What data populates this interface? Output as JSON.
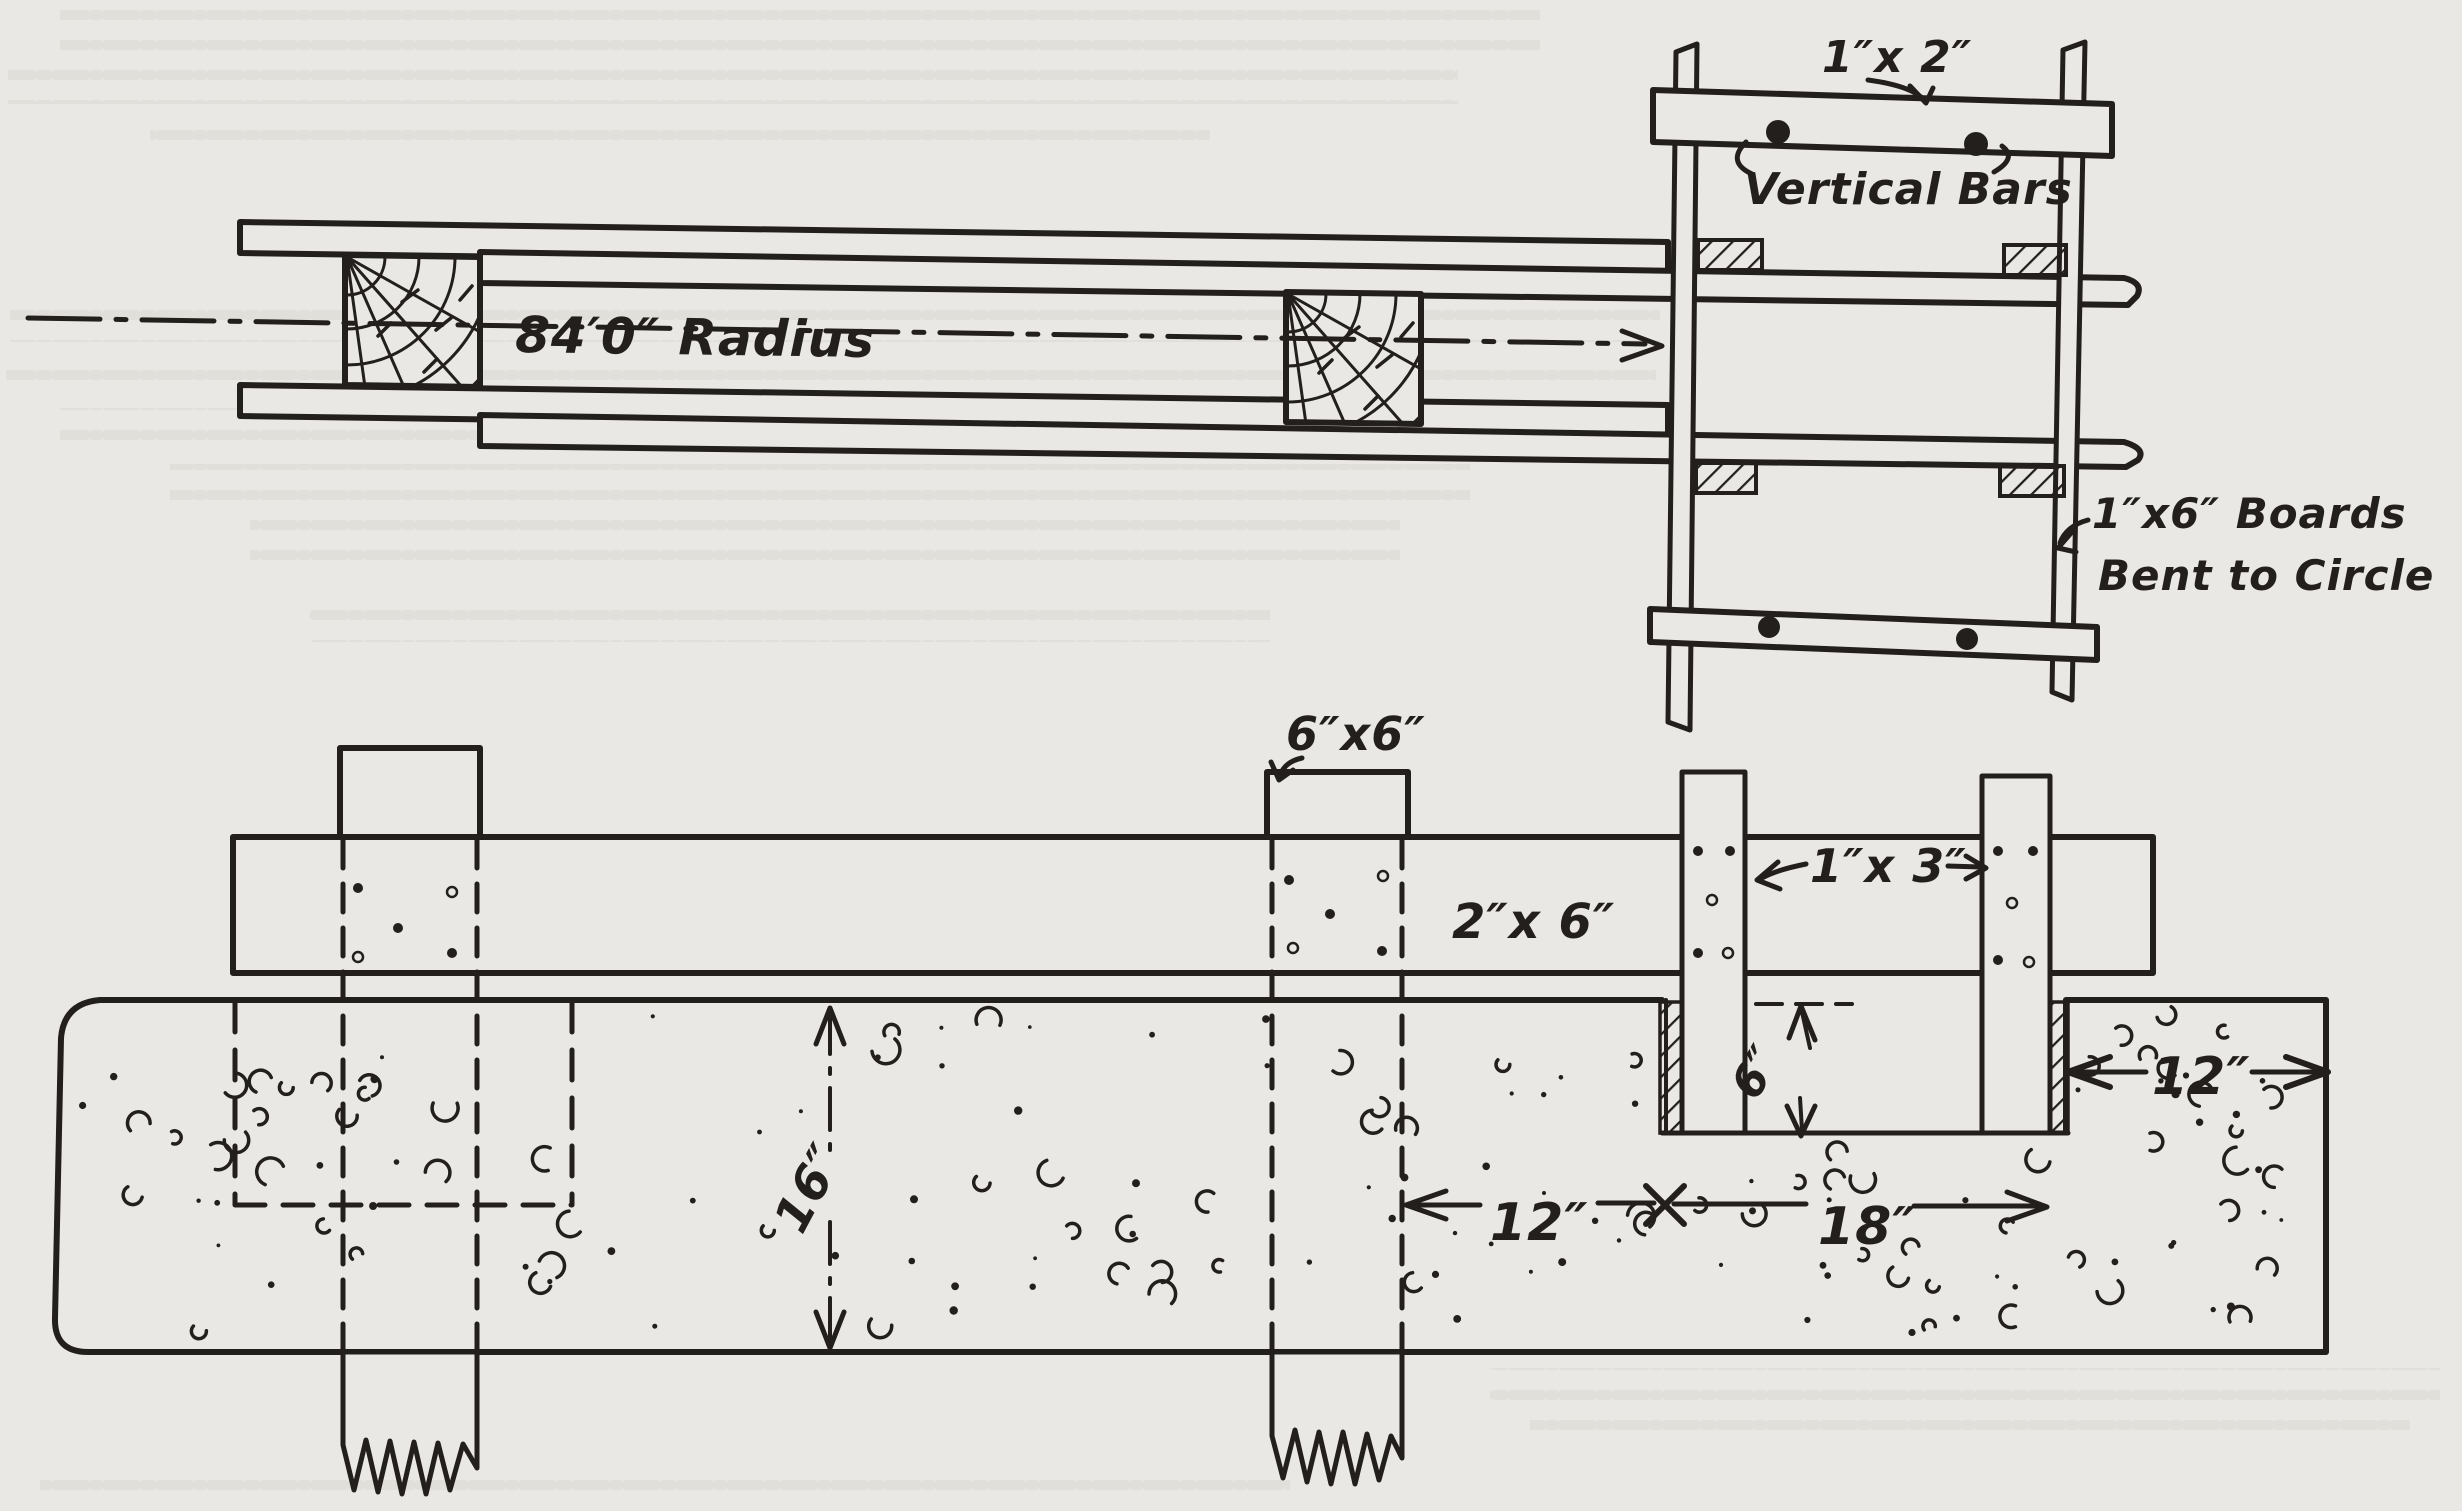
{
  "colors": {
    "ink": "#221f1c",
    "paper": "#eae8e4"
  },
  "plan_view": {
    "radius_label": "84′0″ Radius",
    "batten_label": "1″x 2″",
    "vertical_bars_label": "Vertical Bars",
    "boards_label_line1": "1″x6″ Boards",
    "boards_label_line2": "Bent to Circle"
  },
  "section_view": {
    "post_label": "6″x6″",
    "wale_label": "2″x 6″",
    "stud_label": "1″x 3″",
    "step_depth_label": "6″",
    "slab_thickness_label": "16″",
    "offset_label": "12″",
    "trench_width_label": "18″",
    "edge_offset_label": "12″"
  }
}
